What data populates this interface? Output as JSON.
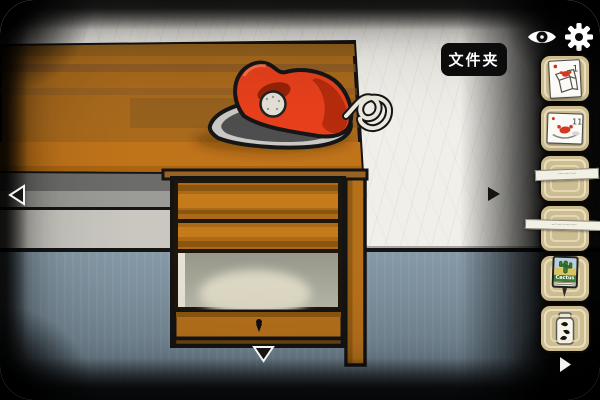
{
  "hud": {
    "item_label": "文件夹",
    "eye_icon": "eye",
    "gear_icon": "gear"
  },
  "navigation": {
    "left_arrow": "◀",
    "right_arrow": "▶",
    "down_arrow": "▼",
    "inventory_more_arrow": "▶"
  },
  "inventory": {
    "slots": [
      {
        "name": "hint-card-box",
        "badge": "1"
      },
      {
        "name": "hint-card-crab-plate",
        "badge": "11"
      },
      {
        "name": "empty-slot",
        "tag": "·‒··‒··‒·"
      },
      {
        "name": "empty-slot",
        "tag": "‒··‒···‒··‒·"
      },
      {
        "name": "cactus-sign",
        "label": "Cactus"
      },
      {
        "name": "shrimp-jar"
      }
    ]
  },
  "scene": {
    "objects": [
      "wooden desk",
      "red clothes iron",
      "coiled iron cord",
      "open compartment",
      "keyhole drawer"
    ],
    "colors": {
      "wall": "#f1efe9",
      "floor": "#7e93a1",
      "wood": "#a96a1c",
      "wood_bright": "#c0741a",
      "wood_dark": "#8a5a28",
      "iron_red": "#e8401c",
      "slot_bg": "#cdbd92",
      "slot_ring": "#f0e5c3",
      "label_bg": "#0c0c0c"
    }
  }
}
